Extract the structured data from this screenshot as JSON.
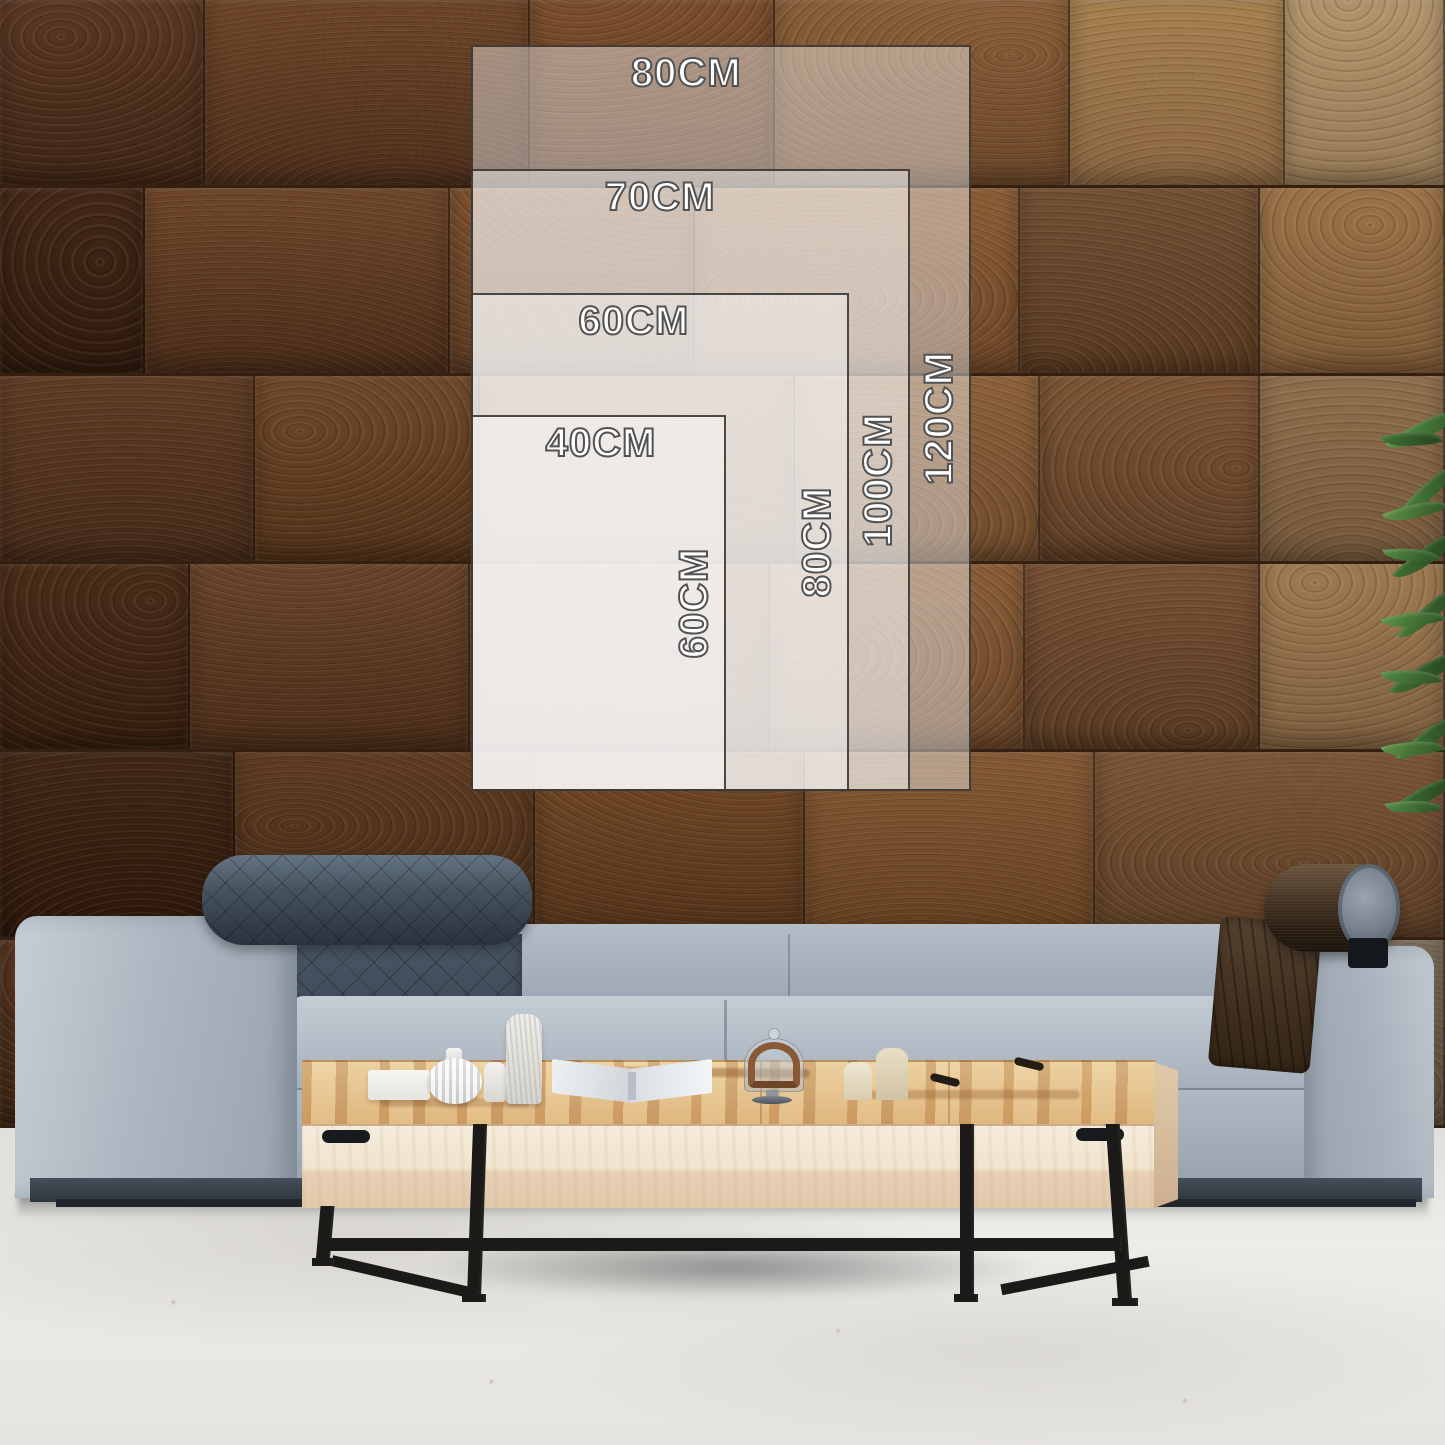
{
  "size_guide": {
    "sizes": [
      {
        "width_label": "80CM",
        "height_label": "120CM"
      },
      {
        "width_label": "70CM",
        "height_label": "100CM"
      },
      {
        "width_label": "60CM",
        "height_label": "80CM"
      },
      {
        "width_label": "40CM",
        "height_label": "60CM"
      }
    ]
  },
  "palette": {
    "wood_dark": "#42281a",
    "wood_mid": "#7a4f2b",
    "wood_light": "#a5804f",
    "sofa_fabric": "#aeb7c1",
    "headrest_slate": "#414d5b",
    "bolster_brown": "#3a2b1d",
    "table_top": "#e6c08c",
    "table_face": "#f0e6d2",
    "leg_black": "#1c1a18",
    "floor": "#e9e7e3",
    "leaf_green": "#3f6b33",
    "overlay_fill": "rgba(255,255,255,0.42)",
    "overlay_border": "#2e2a26",
    "label_text": "#ffffff",
    "label_outline": "#525252"
  }
}
